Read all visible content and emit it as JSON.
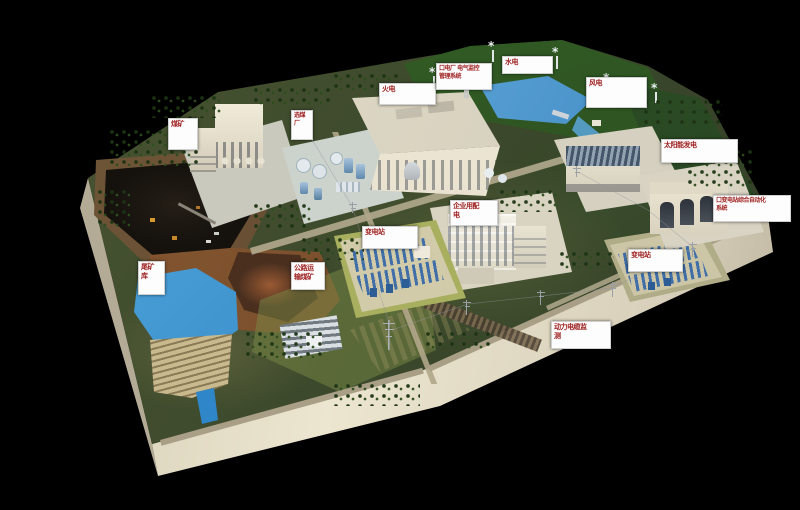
{
  "colors": {
    "background": "#000000",
    "label_bg": "#ffffff",
    "label_text": "#9e1f1f",
    "platform_edge": "#ddd6c1",
    "grass": "#3f4c2e",
    "water": "#2b7fc4",
    "building_cream": "#ece6d4",
    "coal_dark": "#181410",
    "terrain_brown": "#7d4e2e",
    "equipment_blue": "#2f5f96"
  },
  "labels": {
    "coal_mine": "煤矿",
    "coal_washery": "选煤厂",
    "thermal_power": "火电",
    "plant_electrical_monitoring": "口电厂 电气监控\n管理系统",
    "hydro_power": "水电",
    "wind_power": "风电",
    "solar_power": "太阳能发电",
    "substation_automation": "口变电站综合自动化\n系统",
    "enterprise_distribution": "企业用配\n电",
    "substation_center": "变电站",
    "substation_right": "变电站",
    "power_cable_monitoring": "动力电缆监\n测",
    "tailings_pond": "尾矿\n库",
    "coal_road_transport": "公路运\n输煤矿"
  }
}
